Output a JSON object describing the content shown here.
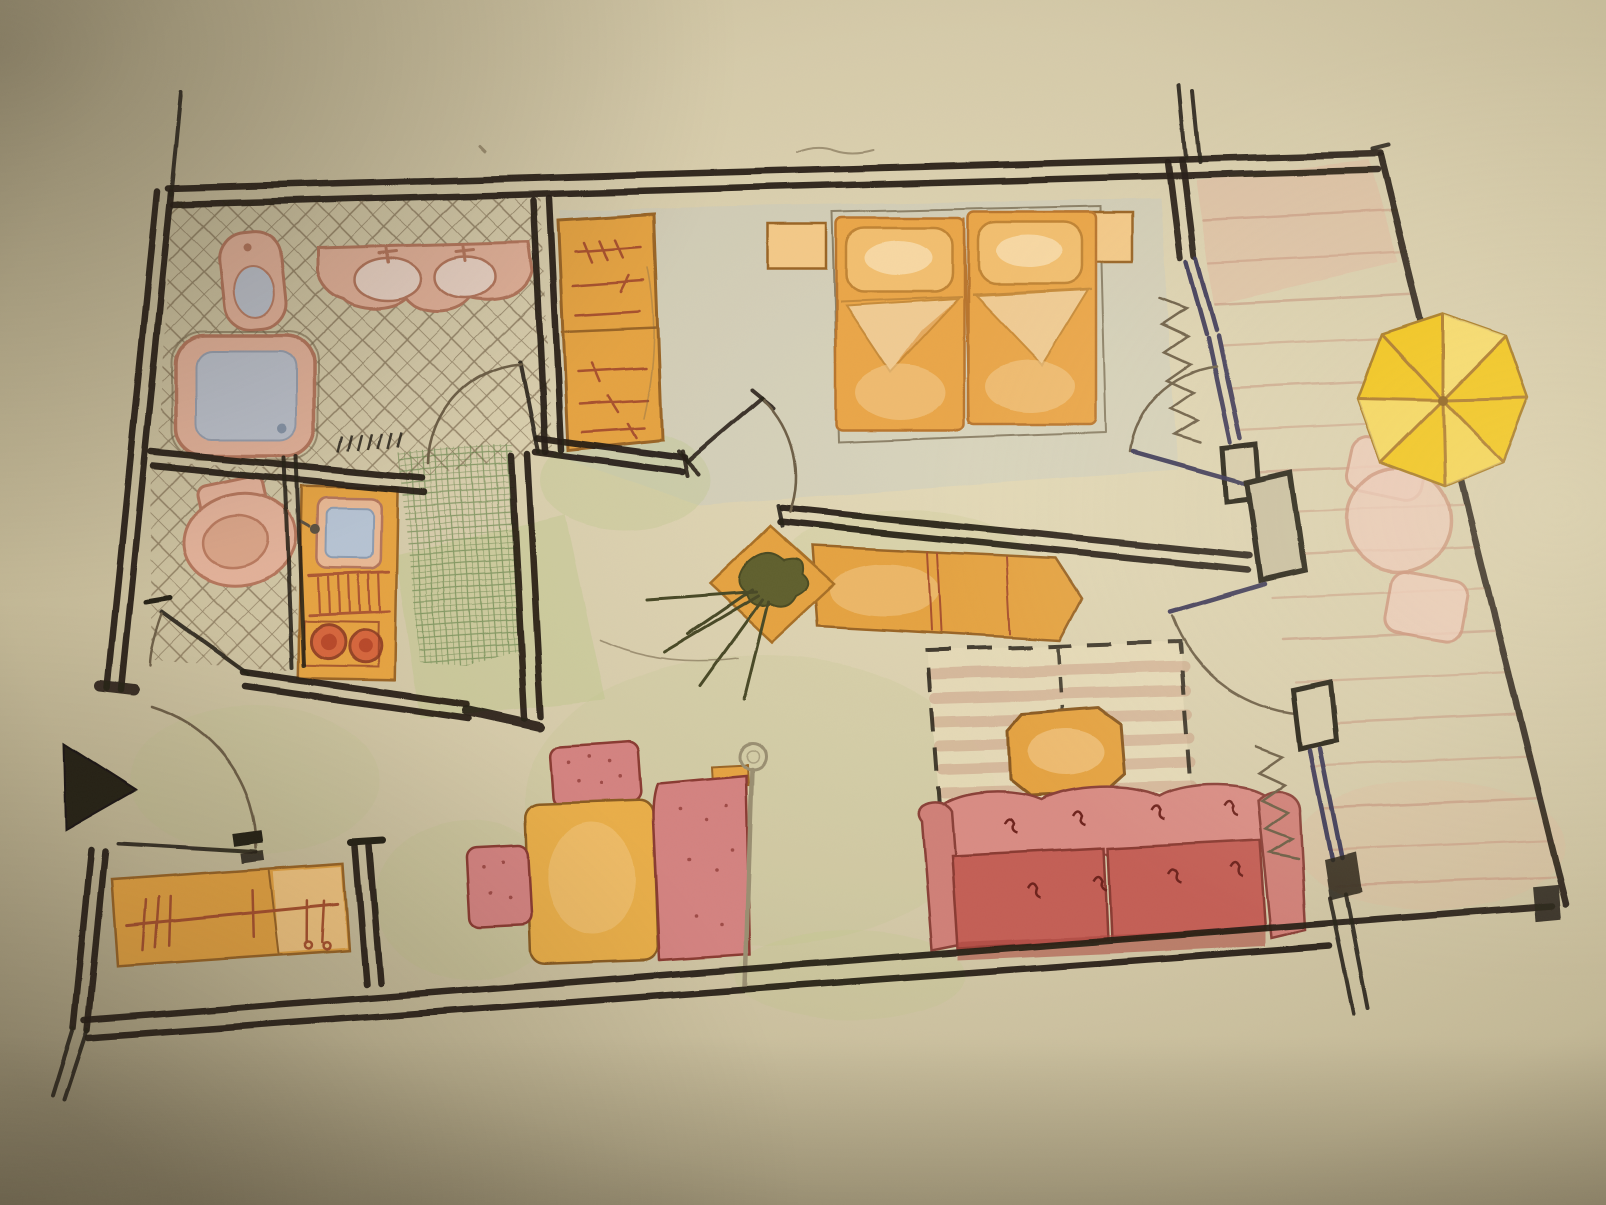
{
  "meta": {
    "description": "Hand-drawn colored-pencil floor plan photo: one-bedroom apartment with bathroom, WC, kitchenette, entrance hall, bedroom, living-dining room and a wooden balcony with parasol"
  },
  "palette": {
    "paper": "#d3c8a6",
    "paperLight": "#e6dcba",
    "paperShadow": "#9b9075",
    "ink": "#272016",
    "pencil": "#6e5f46",
    "navy": "#343052",
    "orange": "#e5a343",
    "orangeLight": "#f3c988",
    "orangeLine": "#9a6527",
    "railRed": "#a8512f",
    "pink": "#e2b199",
    "pinkLine": "#b4765c",
    "water": "#b6c3d3",
    "waterLine": "#8d9cb0",
    "sofaRed": "#cc6a61",
    "sofaLight": "#d98c84",
    "sofaLine": "#7d352c",
    "tuft": "#6e241e",
    "chairRed": "#d48381",
    "chairDot": "#8e3a33",
    "tableOrange": "#e9ae49",
    "umbrella": "#f1c318",
    "umbrellaLight": "#f8e387",
    "umbrellaRib": "#aa7420",
    "deckLine": "#c08a74",
    "deckWash": "#e2b098",
    "balconyPink": "#ecc9b8",
    "balconyLine": "#cb9078",
    "greenWash": "#b5c47e",
    "greenHatch": "#5f7f45",
    "hatch": "#76644a",
    "blueWash": "#b9c4cc",
    "plant": "#565c2e",
    "plantLine": "#3f4422",
    "lampGrey": "#9a8f72"
  },
  "plan": {
    "rooms": [
      {
        "name": "bathroom",
        "floor": "diagonal-tile-hatch",
        "items": [
          "bidet",
          "double-washbasin",
          "bathtub",
          "bath-mat",
          "door"
        ]
      },
      {
        "name": "wc",
        "floor": "diagonal-tile-hatch",
        "items": [
          "toilet",
          "door"
        ]
      },
      {
        "name": "kitchenette",
        "floor": "green-grid-tiles",
        "items": [
          "sink",
          "drainboard",
          "two-burner-stove"
        ]
      },
      {
        "name": "entrance-hall",
        "items": [
          "entrance-door",
          "entrance-arrow",
          "coat-rack-bench"
        ]
      },
      {
        "name": "bedroom",
        "items": [
          "wardrobe",
          "double-bed",
          "two-pillows",
          "two-nightstands",
          "room-door",
          "balcony-door"
        ]
      },
      {
        "name": "living-dining-room",
        "items": [
          "sideboard",
          "plant-stand",
          "rug",
          "coffee-table",
          "sofa",
          "dining-table",
          "two-chairs",
          "bench",
          "floor-lamp",
          "balcony-door",
          "window"
        ]
      },
      {
        "name": "balcony",
        "items": [
          "wood-deck",
          "parasol",
          "garden-table",
          "two-garden-chairs",
          "railing"
        ]
      }
    ],
    "counts": {
      "rooms": 7,
      "doors": 7,
      "windows": 1,
      "balcony_parasols": 1
    }
  }
}
